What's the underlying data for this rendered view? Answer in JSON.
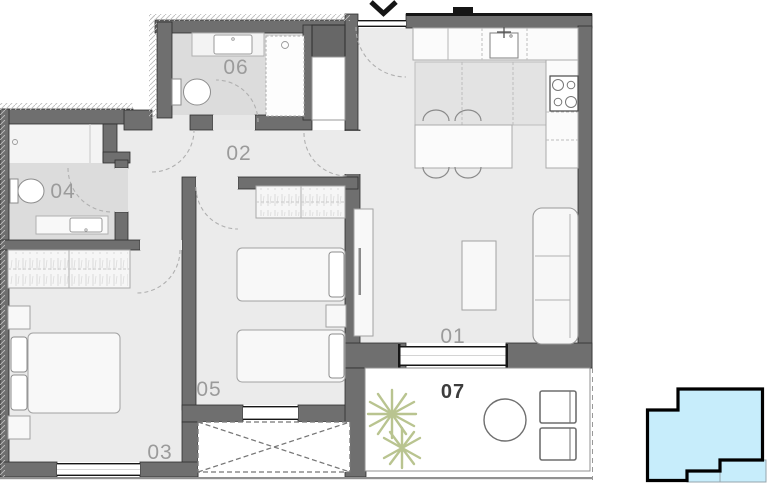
{
  "plan_title": "apartment-floor-plan",
  "rooms": {
    "r01": "01",
    "r02": "02",
    "r03": "03",
    "r04": "04",
    "r05": "05",
    "r06": "06",
    "r07": "07"
  },
  "entry": {
    "marker": "chevron-down"
  },
  "colors": {
    "wall": "#6f6f6f",
    "floor": "#ebebeb",
    "wet_floor": "#dcdcdc",
    "furniture": "#f8f8f8",
    "room_label": "#9b9b9b",
    "balcony_label": "#3d3d3d",
    "plant": "#b9c490",
    "minimap_fill": "#c7edfb",
    "minimap_outline": "#000000"
  }
}
